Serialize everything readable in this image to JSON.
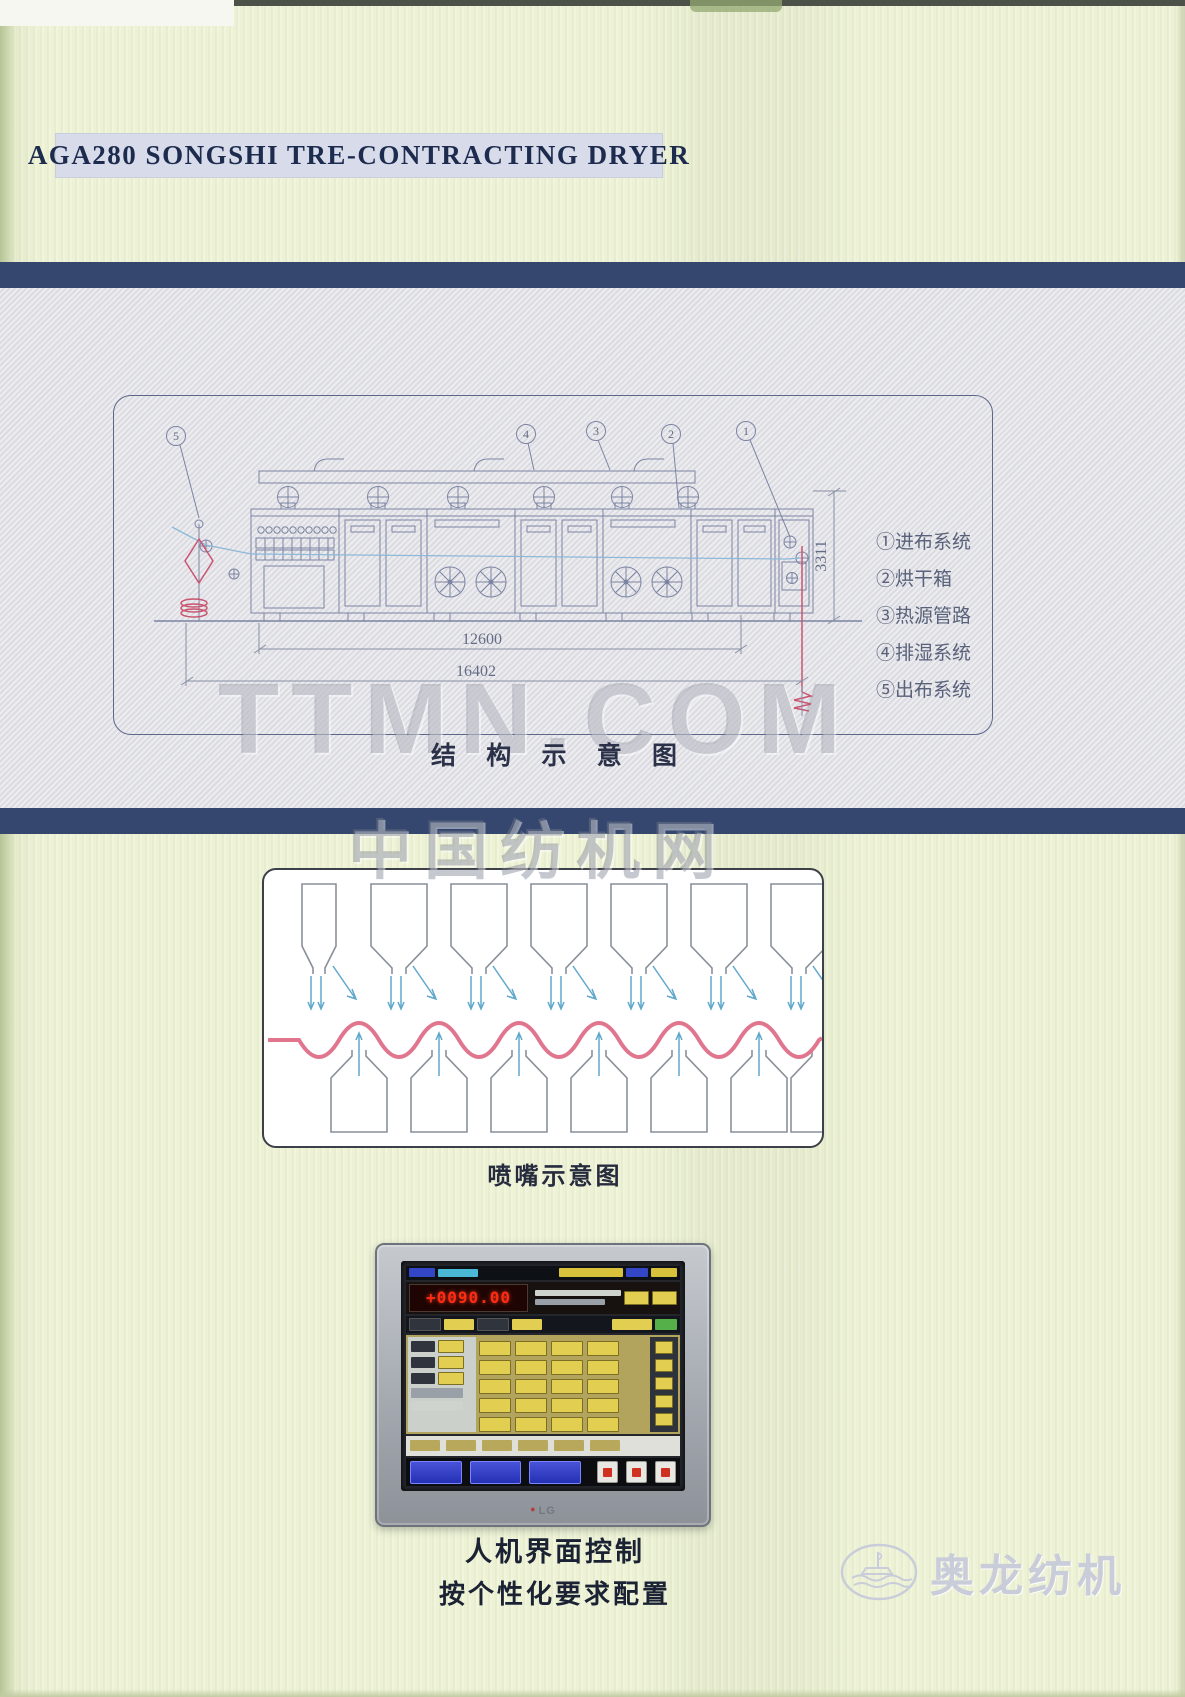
{
  "page": {
    "title": "AGA280 SONGSHI TRE-CONTRACTING DRYER"
  },
  "structure_diagram": {
    "caption": "结 构 示 意 图",
    "dimensions": {
      "height": "3311",
      "inner_length": "12600",
      "total_length": "16402"
    },
    "callouts": [
      "5",
      "4",
      "3",
      "2",
      "1"
    ],
    "legend": [
      {
        "label": "①进布系统"
      },
      {
        "label": "②烘干箱"
      },
      {
        "label": "③热源管路"
      },
      {
        "label": "④排湿系统"
      },
      {
        "label": "⑤出布系统"
      }
    ]
  },
  "watermarks": {
    "ttmn": "TTMN.COM",
    "china_textile_net": "中国纺机网"
  },
  "nozzle_diagram": {
    "caption": "喷嘴示意图"
  },
  "hmi": {
    "led_value": "+0090.00",
    "brand": "LG",
    "description_line1": "人机界面控制",
    "description_line2": "按个性化要求配置"
  },
  "footer_logo": {
    "text": "奥龙纺机"
  },
  "colors": {
    "page_bg": "#edf2d5",
    "band_navy": "#35476e",
    "panel_gray": "#e3e3e8",
    "title_bg": "#d8dcea",
    "wave_pink": "#e0758d",
    "arrow_blue": "#5fa8cc",
    "machine_line": "#7b84a2",
    "accent_red": "#c95570",
    "led_red": "#ff2b12"
  }
}
